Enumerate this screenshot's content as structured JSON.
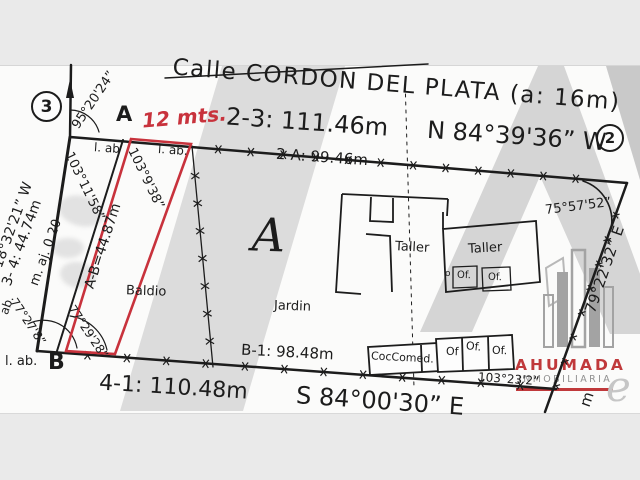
{
  "colors": {
    "red": "#c8323c",
    "ink": "#1c1c1c",
    "logo_red": "#c0393b",
    "logo_gray": "#909090",
    "watermark_gray": "#d8d8d8"
  },
  "street": {
    "name": "Calle CORDON DEL PLATA (a: 16m)"
  },
  "points": {
    "p3": "3",
    "p2": "2",
    "a": "A",
    "b": "B"
  },
  "red_parcel": {
    "note": "12 mts.",
    "ab_length": "A-B=44.87m",
    "angle_top": "103°9'38”",
    "angle_bottom": "77°29'28”",
    "status": "Baldio"
  },
  "boundaries": {
    "top_distance": "2-3: 111.46m",
    "top_bearing": "N 84°39'36” W",
    "top_inner": "2-A: 99.46m",
    "west_bearing": "18°32'21” W",
    "west_distance": "3- 4: 44.74m",
    "west_note": "m. aj. 0.20",
    "west_edge_note": "ab.",
    "bottom_distance": "4-1: 110.48m",
    "bottom_bearing": "S 84°00'30” E",
    "bottom_inner": "B-1: 98.48m",
    "east_bearing": "79°22'32” E",
    "east_fragment": "m"
  },
  "angles": {
    "at_p3": "95°20'24”",
    "at_a_left": "103°11'58”",
    "at_b_left": "77°27'8”",
    "at_p2": "75°57'52”",
    "at_p1": "103°23'2”"
  },
  "site": {
    "lot": "A",
    "garden": "Jardin",
    "workshop_left": "Taller",
    "workshop_right": "Taller",
    "kitchen": "CocComed.",
    "office_r1": "Of",
    "office_r2": "Of.",
    "office_r3": "Of.",
    "office_small": "o",
    "office1": "Of.",
    "office2": "Of.",
    "boundary_note_top_left": "l. ab",
    "boundary_note_top_right": "l. ab.",
    "boundary_note_bottom": "l. ab."
  },
  "logo": {
    "name": "AHUMADA",
    "tagline": "INMOBILIARIA"
  }
}
